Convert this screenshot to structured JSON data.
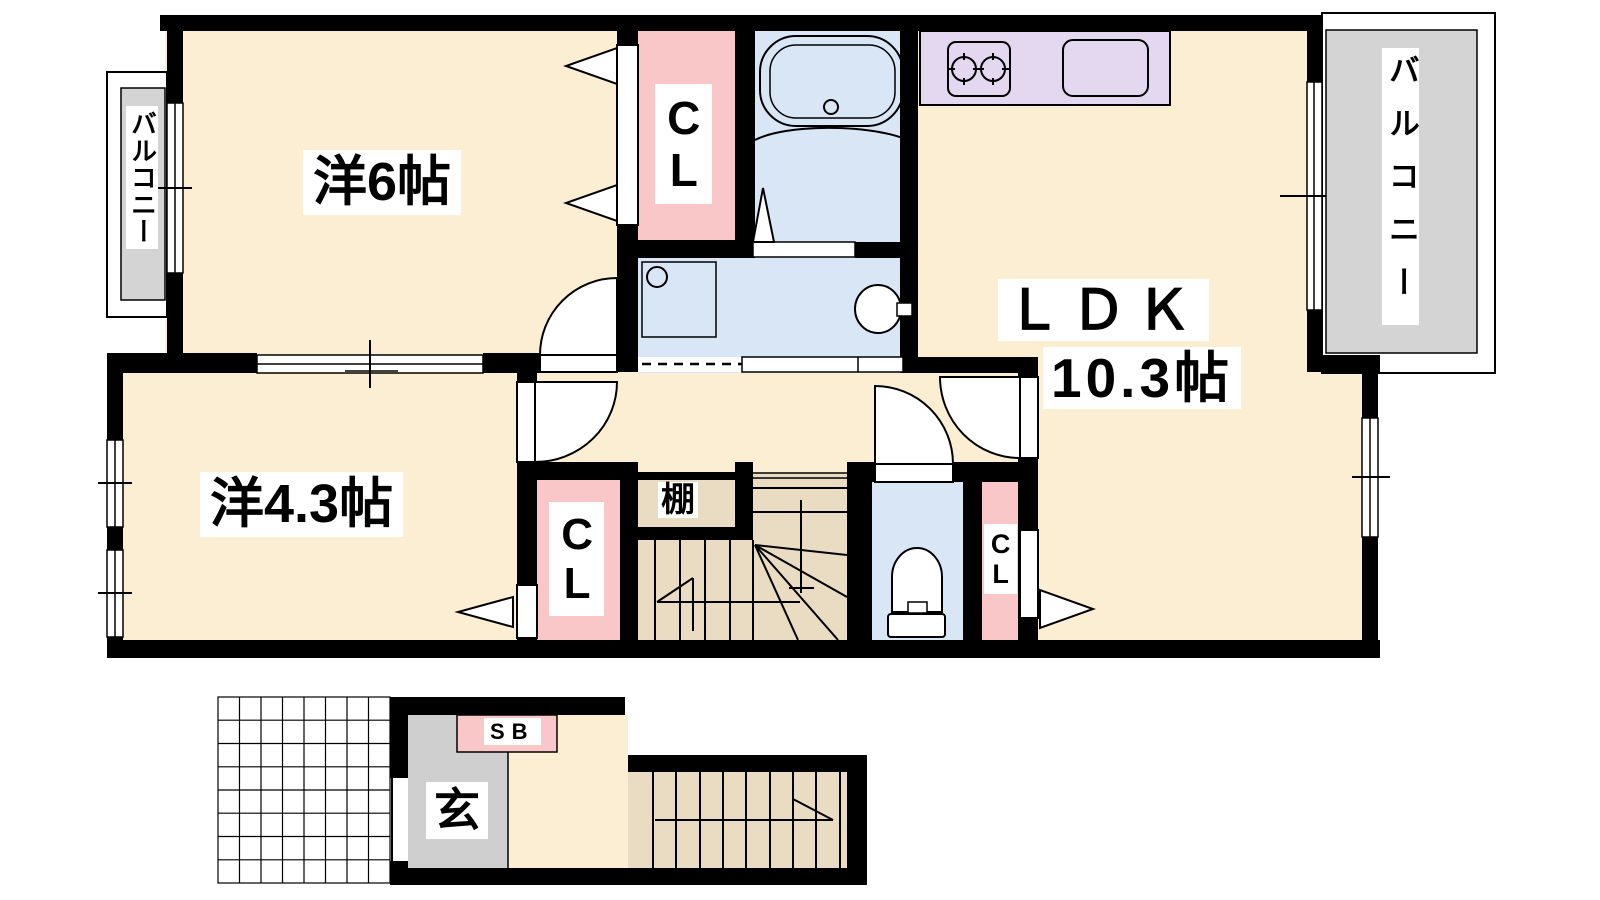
{
  "labels": {
    "room_western_6": "洋6帖",
    "room_western_43": "洋4.3帖",
    "ldk_name": "ＬＤＫ",
    "ldk_size": "10.3帖",
    "closet_top": "CL",
    "closet_bottom_left": "CL",
    "closet_right": "CL",
    "shelf": "棚",
    "balcony_left": "バルコニー",
    "balcony_right": "バルコニー",
    "genkan": "玄",
    "shoe_box": "SB"
  },
  "colors": {
    "floor_cream": "#FBEED2",
    "wet_area_blue": "#D8E6F6",
    "closet_pink": "#FAC7C9",
    "kitchen_lavender": "#E4D8F0",
    "stair_tan": "#EADCC3",
    "balcony_gray": "#D4D4D4",
    "genkan_gray": "#CFCFCF",
    "wall_black": "#000000"
  }
}
